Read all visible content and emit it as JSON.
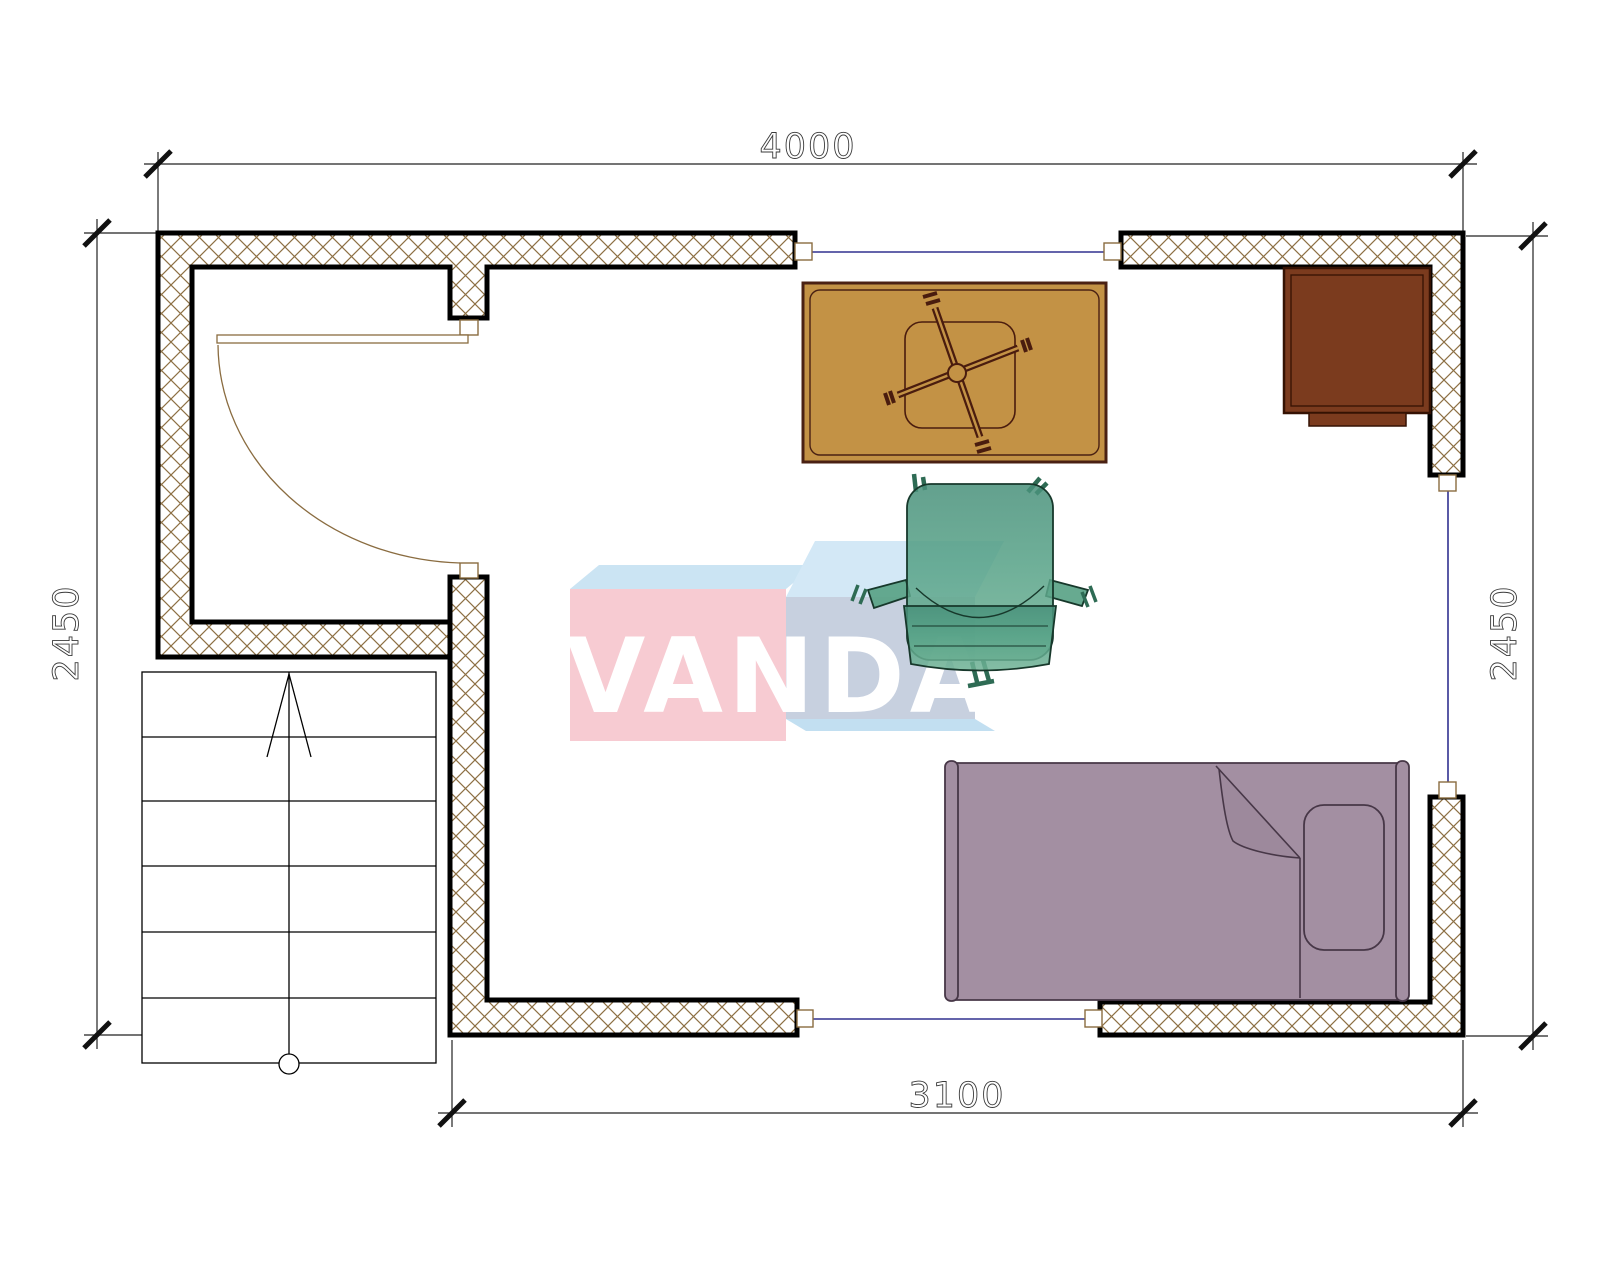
{
  "drawing": {
    "type": "floor-plan",
    "background": "#ffffff"
  },
  "dimensions": {
    "top": "4000",
    "left": "2450",
    "right": "2450",
    "bottom": "3100"
  },
  "watermark": {
    "text": "VANDA",
    "front_left_color": "#F7CBD2",
    "top_left_color": "#CBE4F3",
    "top_right_color": "#D3E8F6",
    "front_right_color": "#C7D0DF",
    "bottom_sliver_color": "#C2DFF1",
    "text_color": "#FFFFFF"
  },
  "colors": {
    "wall_outline": "#000000",
    "wall_hatch": "#8d7044",
    "window_line": "#30308F",
    "door_line": "#8a6c40",
    "dimension_line": "#222222",
    "dimension_text_outline": "#3a3a3a",
    "desk_fill": "#C39245",
    "desk_outline": "#4a2113",
    "cabinet_fill": "#7B3B1E",
    "cabinet_outline": "#351203",
    "bed_fill": "#A38FA2",
    "bed_outline": "#473747",
    "armchair_fill": "#57A184",
    "armchair_outline": "#17382B",
    "stairs_line": "#000000"
  }
}
